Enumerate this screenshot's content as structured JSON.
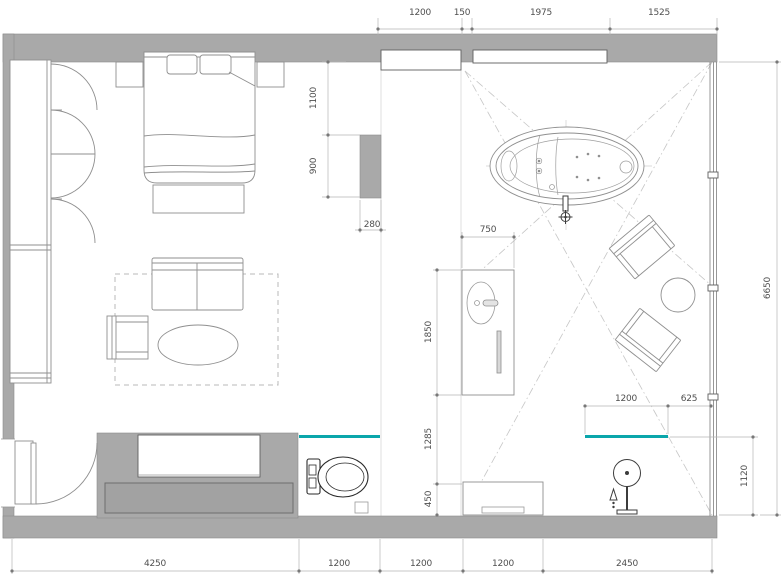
{
  "title": "Hotel suite floor plan",
  "colors": {
    "wall": "#a9a9a9",
    "console": "#a2a2a2",
    "glass": "#0aa6ab",
    "line_light": "#8f8f8f",
    "fixture_dark": "#2a2a2a",
    "dim_text": "#4f4f4f"
  },
  "dims": {
    "top": [
      "1200",
      "150",
      "1975",
      "1525"
    ],
    "bottom": [
      "4250",
      "1200",
      "1200",
      "1200",
      "2450"
    ],
    "left": [
      "1100",
      "900"
    ],
    "partition": "280",
    "vanity_top": "750",
    "mid": [
      "1850",
      "1285",
      "450"
    ],
    "shower": [
      "1200",
      "625"
    ],
    "glass_height": "1120",
    "room_height": "6650"
  },
  "fixtures": [
    "wardrobe",
    "double-bed",
    "nightstand",
    "bed-bench",
    "sofa",
    "armchair",
    "coffee-table",
    "rug",
    "tv-wall",
    "tv-console",
    "entry-door",
    "toilet",
    "glass-partition",
    "vanity-basin",
    "towel-bar",
    "shower-bench",
    "shower-column",
    "freestanding-bathtub",
    "lounge-chair",
    "side-table",
    "window-wall"
  ]
}
